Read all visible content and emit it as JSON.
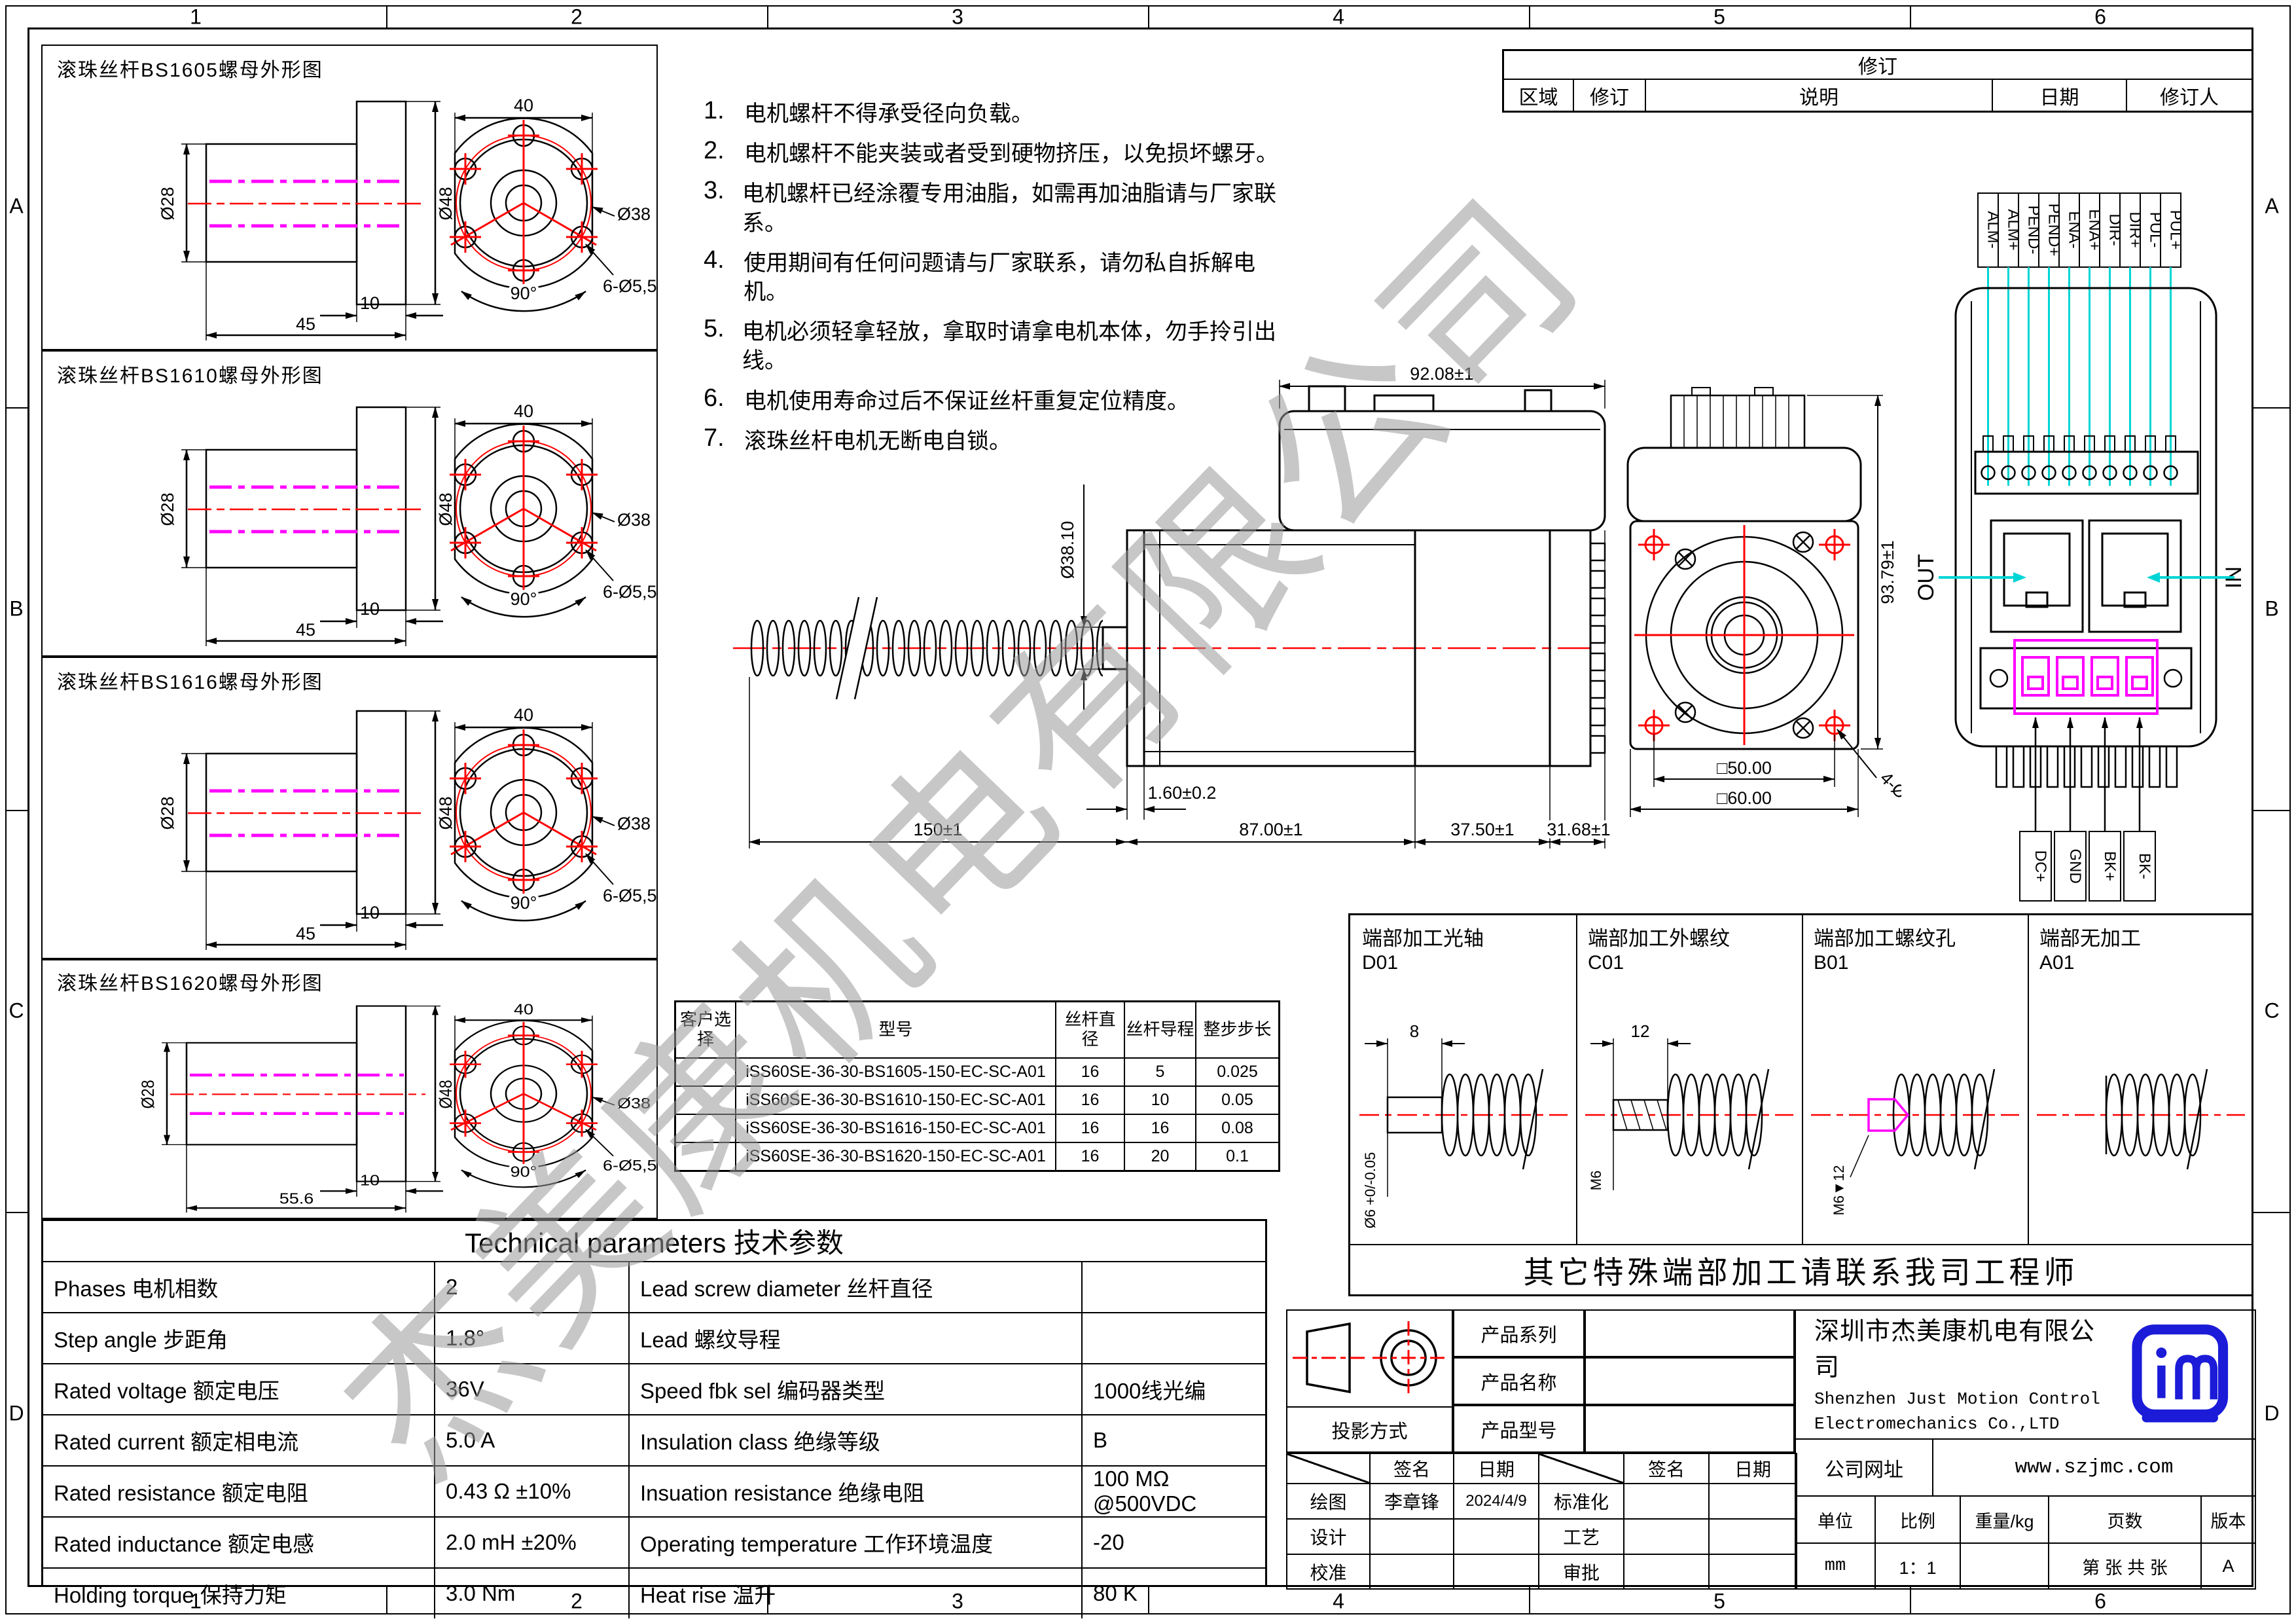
{
  "colors": {
    "centerline": "#ff0000",
    "hidden_line": "#ff00ff",
    "wire": "#00d5d5",
    "logo": "#1b1bd8",
    "watermark": "#9a9a9a"
  },
  "sheet": {
    "cols": [
      "1",
      "2",
      "3",
      "4",
      "5",
      "6"
    ],
    "rows": [
      "A",
      "B",
      "C",
      "D"
    ]
  },
  "watermark": "杰美康机电有限公司",
  "notes": [
    {
      "n": "1.",
      "t": "电机螺杆不得承受径向负载。"
    },
    {
      "n": "2.",
      "t": "电机螺杆不能夹装或者受到硬物挤压，以免损坏螺牙。"
    },
    {
      "n": "3.",
      "t": "电机螺杆已经涂覆专用油脂，如需再加油脂请与厂家联系。"
    },
    {
      "n": "4.",
      "t": "使用期间有任何问题请与厂家联系，请勿私自拆解电机。"
    },
    {
      "n": "5.",
      "t": "电机必须轻拿轻放，拿取时请拿电机本体，勿手拎引出线。"
    },
    {
      "n": "6.",
      "t": "电机使用寿命过后不保证丝杆重复定位精度。"
    },
    {
      "n": "7.",
      "t": "滚珠丝杆电机无断电自锁。"
    }
  ],
  "nut_panels": [
    {
      "title": "滚珠丝杆BS1605螺母外形图",
      "bore": "Ø28",
      "od": "Ø48",
      "flange_w": "10",
      "length": "45",
      "width": "40",
      "bolt_circle": "Ø38",
      "holes": "6-Ø5,5",
      "angle": "90°"
    },
    {
      "title": "滚珠丝杆BS1610螺母外形图",
      "bore": "Ø28",
      "od": "Ø48",
      "flange_w": "10",
      "length": "45",
      "width": "40",
      "bolt_circle": "Ø38",
      "holes": "6-Ø5,5",
      "angle": "90°"
    },
    {
      "title": "滚珠丝杆BS1616螺母外形图",
      "bore": "Ø28",
      "od": "Ø48",
      "flange_w": "10",
      "length": "45",
      "width": "40",
      "bolt_circle": "Ø38",
      "holes": "6-Ø5,5",
      "angle": "90°"
    },
    {
      "title": "滚珠丝杆BS1620螺母外形图",
      "bore": "Ø28",
      "od": "Ø48",
      "flange_w": "10",
      "length": "55.6",
      "width": "40",
      "bolt_circle": "Ø38",
      "holes": "6-Ø5,5",
      "angle": "90°"
    }
  ],
  "main_view": {
    "dim_width": "92.08±1",
    "dim_boss": "Ø38.10",
    "dim_plate": "1.60±0.2",
    "dim_screw": "150±1",
    "dim_body": "87.00±1",
    "dim_mid": "37.50±1",
    "dim_rear": "31.68±1"
  },
  "front_view": {
    "dim_height": "93.79±1",
    "dim_bolt_span": "□50.00",
    "dim_frame": "□60.00",
    "dim_holes": "4-Ø5.00"
  },
  "connector_view": {
    "pins": [
      "ALM-",
      "ALM+",
      "PEND-",
      "PEND+",
      "ENA-",
      "ENA+",
      "DIR-",
      "DIR+",
      "PUL-",
      "PUL+"
    ],
    "out": "OUT",
    "in": "IN",
    "power_pins": [
      "DC+",
      "GND",
      "BK+",
      "BK-"
    ]
  },
  "end_machining": {
    "options": [
      {
        "name": "端部加工光轴",
        "code": "D01",
        "dim_len": "8",
        "dim_dia": "Ø6 +0/-0.05"
      },
      {
        "name": "端部加工外螺纹",
        "code": "C01",
        "dim_len": "12",
        "dim_dia": "M6"
      },
      {
        "name": "端部加工螺纹孔",
        "code": "B01",
        "dim_len": "",
        "dim_dia": "M6▼12"
      },
      {
        "name": "端部无加工",
        "code": "A01",
        "dim_len": "",
        "dim_dia": ""
      }
    ],
    "note": "其它特殊端部加工请联系我司工程师"
  },
  "model_table": {
    "headers": [
      "客户选择",
      "型号",
      "丝杆直径",
      "丝杆导程",
      "整步步长"
    ],
    "rows": [
      [
        "iSS60SE-36-30-BS1605-150-EC-SC-A01",
        "16",
        "5",
        "0.025"
      ],
      [
        "iSS60SE-36-30-BS1610-150-EC-SC-A01",
        "16",
        "10",
        "0.05"
      ],
      [
        "iSS60SE-36-30-BS1616-150-EC-SC-A01",
        "16",
        "16",
        "0.08"
      ],
      [
        "iSS60SE-36-30-BS1620-150-EC-SC-A01",
        "16",
        "20",
        "0.1"
      ]
    ]
  },
  "tech_params": {
    "title": "Technical parameters 技术参数",
    "left": [
      {
        "label": "Phases 电机相数",
        "value": "2"
      },
      {
        "label": "Step angle 步距角",
        "value": "1.8°"
      },
      {
        "label": "Rated voltage 额定电压",
        "value": "36V"
      },
      {
        "label": "Rated current 额定相电流",
        "value": "5.0 A"
      },
      {
        "label": "Rated resistance 额定电阻",
        "value": "0.43 Ω  ±10%"
      },
      {
        "label": "Rated inductance 额定电感",
        "value": "2.0 mH ±20%"
      },
      {
        "label": "Holding torque 保持力矩",
        "value": "3.0 Nm"
      }
    ],
    "right": [
      {
        "label": "Lead screw diameter 丝杆直径",
        "value": ""
      },
      {
        "label": "Lead 螺纹导程",
        "value": ""
      },
      {
        "label": "Speed fbk sel  编码器类型",
        "value": "1000线光编"
      },
      {
        "label": "Insulation class 绝缘等级",
        "value": "B"
      },
      {
        "label": "Insuation resistance 绝缘电阻",
        "value": "100 MΩ @500VDC"
      },
      {
        "label": "Operating temperature 工作环境温度",
        "value": "-20"
      },
      {
        "label": "Heat rise 温升",
        "value": "80 K"
      }
    ]
  },
  "revision": {
    "title": "修订",
    "headers": [
      "区域",
      "修订",
      "说明",
      "日期",
      "修订人"
    ]
  },
  "title_block": {
    "projection_label": "投影方式",
    "product_series_label": "产品系列",
    "product_name_label": "产品名称",
    "product_model_label": "产品型号",
    "sign_label": "签名",
    "date_label": "日期",
    "left_roles": [
      {
        "role": "绘图",
        "sign": "李章锋",
        "date": "2024/4/9"
      },
      {
        "role": "设计",
        "sign": "",
        "date": ""
      },
      {
        "role": "校准",
        "sign": "",
        "date": ""
      }
    ],
    "right_roles": [
      {
        "role": "标准化",
        "sign": "",
        "date": ""
      },
      {
        "role": "工艺",
        "sign": "",
        "date": ""
      },
      {
        "role": "审批",
        "sign": "",
        "date": ""
      }
    ],
    "company_cn": "深圳市杰美康机电有限公司",
    "company_en1": "Shenzhen Just Motion Control",
    "company_en2": "Electromechanics Co.,LTD",
    "website_label": "公司网址",
    "website": "www.szjmc.com",
    "unit_label": "单位",
    "unit": "mm",
    "scale_label": "比例",
    "scale": "1：1",
    "weight_label": "重量/kg",
    "weight": "",
    "pages_label": "页数",
    "pages": "第 张 共 张",
    "version_label": "版本",
    "version": "A"
  }
}
